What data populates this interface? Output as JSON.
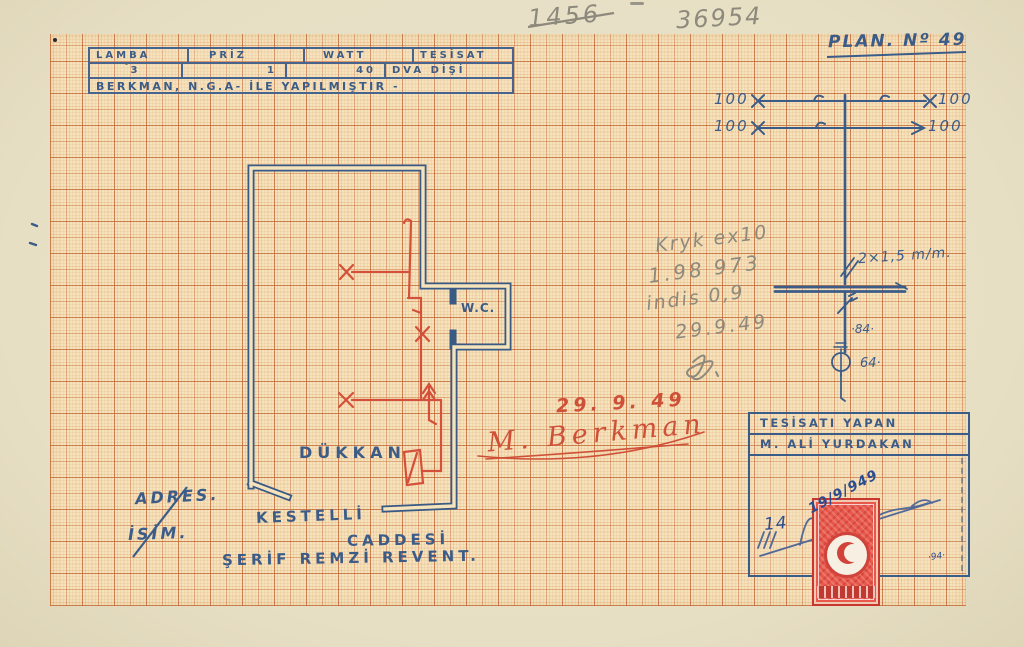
{
  "page": {
    "pencil_header": {
      "crossed_number": "1456",
      "number": "36954"
    },
    "plan_no": "PLAN. Nº 49",
    "spec_table": {
      "headers": [
        "LAMBA",
        "PRİZ",
        "WATT",
        "TESİSAT"
      ],
      "values": [
        "3",
        "1",
        "40",
        "DVA DİŞİ"
      ],
      "note": "BERKMAN, N.G.A- İLE YAPILMIŞTIR -"
    },
    "riser": {
      "top_left_1": "100",
      "top_right_1": "100",
      "top_left_2": "100",
      "top_right_2": "100",
      "cable_label": "2×1,5 m/m.",
      "switch_label": "·84·",
      "lamp_label": "64·"
    },
    "pencil_notes": {
      "line1": "Kryk ex10",
      "line2": "1.98 973",
      "line3": "indis 0,9",
      "line4": "29.9.49"
    },
    "approval": {
      "date": "29. 9. 49",
      "signature": "M. Berkman"
    },
    "floor_plan": {
      "room_label": "DÜKKAN",
      "wc_label": "W.C."
    },
    "address": {
      "label_address": "ADRES.",
      "label_name": "İSİM.",
      "street_line1": "KESTELLİ",
      "street_line2": "CADDESİ",
      "owner": "ŞERİF REMZİ REVENT."
    },
    "installer_box": {
      "title": "TESİSATI YAPAN",
      "name": "M. ALİ YURDAKAN",
      "stamp_date": "19/9/949",
      "fee": "14",
      "note": "·94·"
    },
    "colors": {
      "blue_ink": "#3b5c88",
      "blue_pen": "#2b4d8f",
      "red_ink": "#cf5038",
      "pencil": "#8d897c",
      "paper": "#e9e1c6",
      "grid_bg": "#f5e3bc",
      "stamp_red": "#d8493f"
    }
  }
}
